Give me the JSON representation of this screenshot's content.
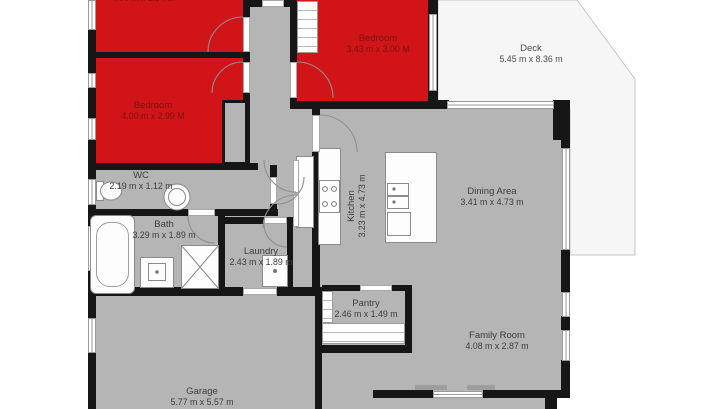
{
  "meta": {
    "type": "floor-plan"
  },
  "colors": {
    "highlight_room": "#d01418",
    "floor": "#b5b5b5",
    "wall": "#161616",
    "deck": "#f6f6f6",
    "background": "#ffffff"
  },
  "rooms": {
    "top_left_room": {
      "name": "",
      "dims": "4.00 m x 2.94 M"
    },
    "bedroom_left": {
      "name": "Bedroom",
      "dims": "4.00 m x 2.99 M"
    },
    "bedroom_top": {
      "name": "Bedroom",
      "dims": "3.43 m x 3.00 M"
    },
    "deck": {
      "name": "Deck",
      "dims": "5.45 m x 8.36 m"
    },
    "wc": {
      "name": "WC",
      "dims": "2.19 m x 1.12 m"
    },
    "bath": {
      "name": "Bath",
      "dims": "3.29 m x 1.89 m"
    },
    "laundry": {
      "name": "Laundry",
      "dims": "2.43 m x 1.89 m"
    },
    "kitchen": {
      "name": "Kitchen",
      "dims": "3.23 m x 4.73 m"
    },
    "dining": {
      "name": "Dining Area",
      "dims": "3.41 m x 4.73 m"
    },
    "pantry": {
      "name": "Pantry",
      "dims": "2.46 m x 1.49 m"
    },
    "family": {
      "name": "Family Room",
      "dims": "4.08 m x 2.87 m"
    },
    "garage": {
      "name": "Garage",
      "dims": "5.77 m x 5.57 m"
    }
  }
}
